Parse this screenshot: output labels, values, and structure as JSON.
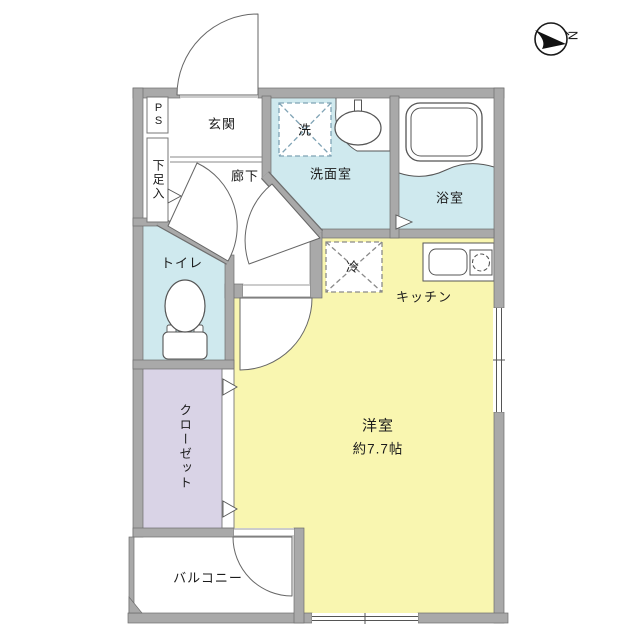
{
  "title": "apartment-floor-plan",
  "compass": {
    "north_label": "N"
  },
  "rooms": {
    "genkan": {
      "label": "玄関"
    },
    "hallway": {
      "label": "廊下"
    },
    "washroom": {
      "label": "洗面室"
    },
    "bathroom": {
      "label": "浴室"
    },
    "toilet": {
      "label": "トイレ"
    },
    "kitchen": {
      "label": "キッチン"
    },
    "living": {
      "label": "洋室",
      "size": "約7.7帖"
    },
    "closet": {
      "label": "クローゼット"
    },
    "balcony": {
      "label": "バルコニー"
    }
  },
  "fixtures": {
    "washer_space": {
      "label": "洗"
    },
    "fridge_space": {
      "label": "冷"
    },
    "pipe_space": {
      "label": "PS"
    },
    "shoe_cabinet": {
      "label": "下足入"
    }
  },
  "colors": {
    "wall": "#a9a9a9",
    "wall_edge": "#6e6e6e",
    "wet_area": "#cfe9ee",
    "living_area": "#f9f6b0",
    "closet_area": "#d9d3e6",
    "washer_dash": "#7fa3b5",
    "line": "#555555"
  }
}
